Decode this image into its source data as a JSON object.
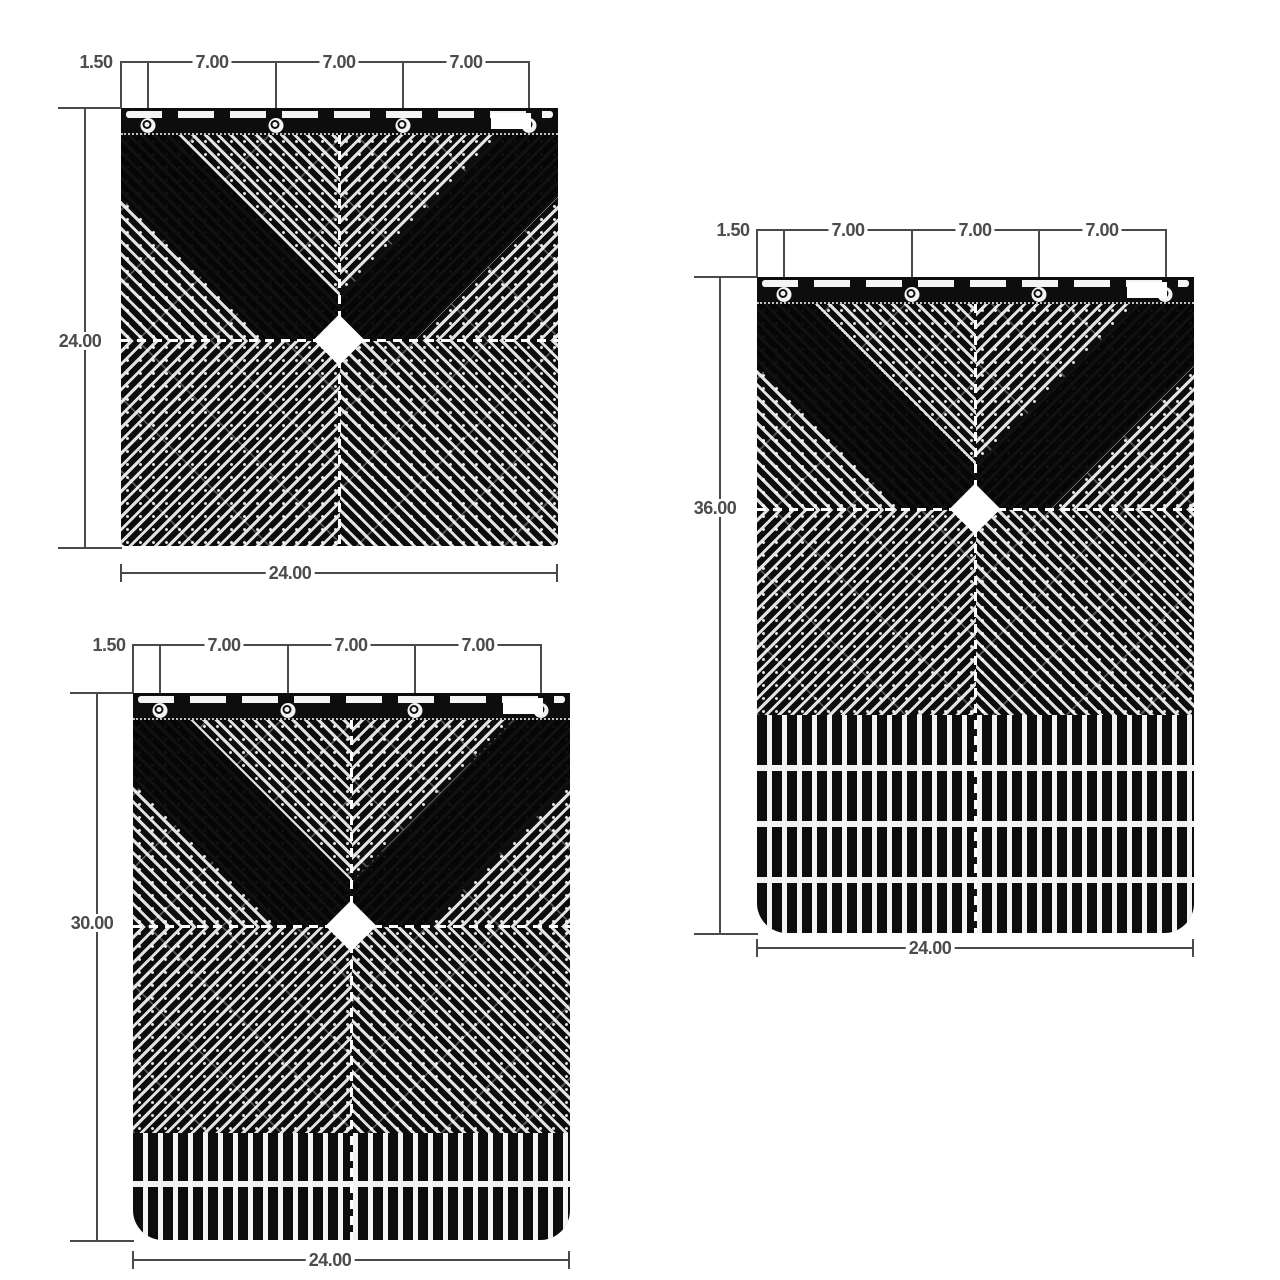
{
  "drawing": {
    "title": "Mud flap dimension drawing",
    "flap_color": "#0d0d0d",
    "line_color": "#4a4a4a",
    "background": "#ffffff"
  },
  "flaps": [
    {
      "name": "mud-flap-24x24",
      "top_offset": "1.50",
      "spacing": [
        "7.00",
        "7.00",
        "7.00"
      ],
      "height": "24.00",
      "width": "24.00"
    },
    {
      "name": "mud-flap-24x30",
      "top_offset": "1.50",
      "spacing": [
        "7.00",
        "7.00",
        "7.00"
      ],
      "height": "30.00",
      "width": "24.00"
    },
    {
      "name": "mud-flap-24x36",
      "top_offset": "1.50",
      "spacing": [
        "7.00",
        "7.00",
        "7.00"
      ],
      "height": "36.00",
      "width": "24.00"
    }
  ]
}
